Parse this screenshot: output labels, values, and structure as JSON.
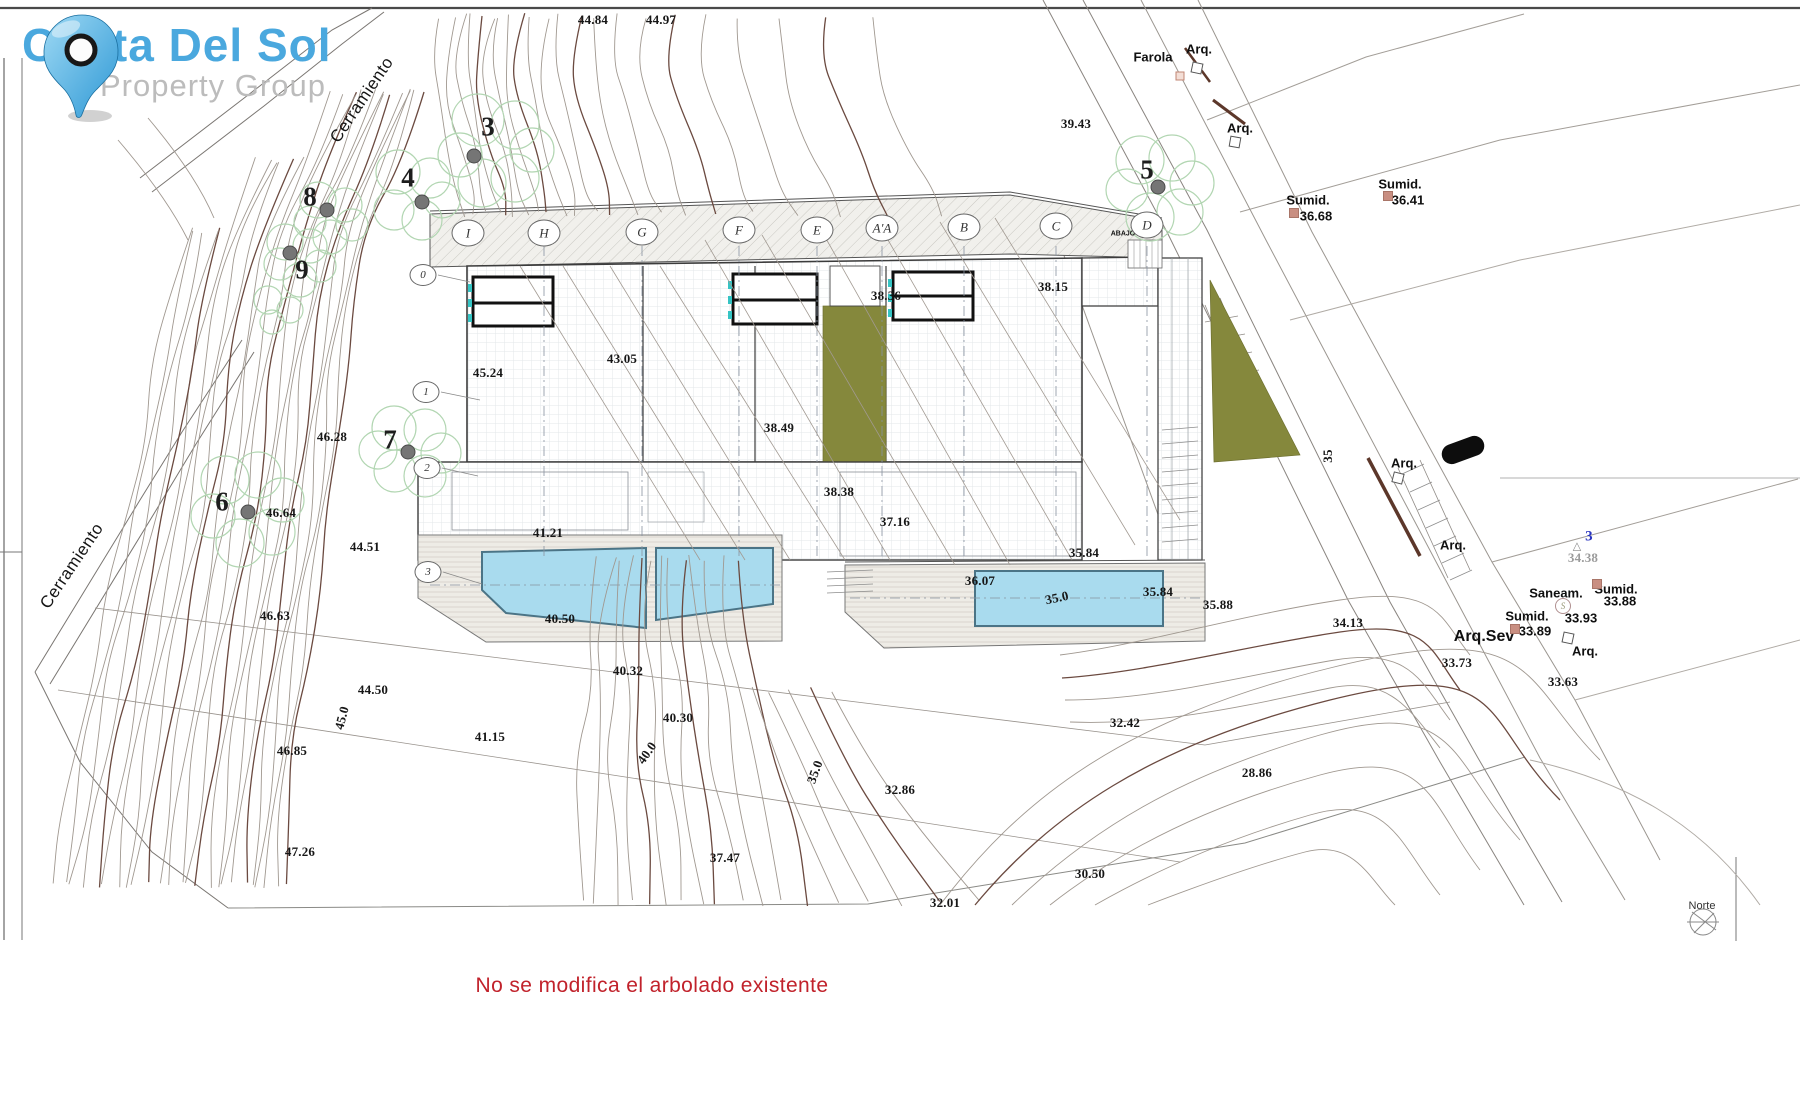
{
  "logo": {
    "title": "Costa Del Sol",
    "subtitle": "Property Group",
    "title_color": "#4aa8de",
    "subtitle_color": "#bcbcbc"
  },
  "note": {
    "text": "No se modifica el arbolado existente",
    "color": "#c1222b"
  },
  "compass": {
    "label": "Norte"
  },
  "colors": {
    "contour": "#a09890",
    "contour_index": "#6b4a40",
    "pool": "#a9dbee",
    "olive": "#85883c",
    "tree_canopy": "#b2d6b2",
    "marker_salmon": "#c98f82",
    "note_red": "#c1222b",
    "logo_blue": "#4aa8de"
  },
  "boundary_labels": [
    {
      "t": "Cerramiento",
      "x": 362,
      "y": 100,
      "r": -56
    },
    {
      "t": "Cerramiento",
      "x": 72,
      "y": 566,
      "r": -56
    }
  ],
  "grid_bubbles": [
    {
      "t": "I",
      "x": 468,
      "y": 233
    },
    {
      "t": "H",
      "x": 544,
      "y": 233
    },
    {
      "t": "G",
      "x": 642,
      "y": 232
    },
    {
      "t": "F",
      "x": 739,
      "y": 230
    },
    {
      "t": "E",
      "x": 817,
      "y": 230
    },
    {
      "t": "A'A",
      "x": 882,
      "y": 228
    },
    {
      "t": "B",
      "x": 964,
      "y": 227
    },
    {
      "t": "C",
      "x": 1056,
      "y": 226
    },
    {
      "t": "D",
      "x": 1147,
      "y": 225
    }
  ],
  "level_bubbles": [
    {
      "t": "0",
      "x": 423,
      "y": 275
    },
    {
      "t": "1",
      "x": 426,
      "y": 392
    },
    {
      "t": "2",
      "x": 427,
      "y": 468
    },
    {
      "t": "3",
      "x": 428,
      "y": 572
    }
  ],
  "tree_numbers": [
    {
      "t": "3",
      "x": 488,
      "y": 127
    },
    {
      "t": "4",
      "x": 408,
      "y": 178
    },
    {
      "t": "8",
      "x": 310,
      "y": 197
    },
    {
      "t": "9",
      "x": 302,
      "y": 270
    },
    {
      "t": "7",
      "x": 390,
      "y": 440
    },
    {
      "t": "6",
      "x": 222,
      "y": 502
    },
    {
      "t": "5",
      "x": 1147,
      "y": 170
    }
  ],
  "elevation_labels": [
    {
      "t": "44.84",
      "x": 593,
      "y": 20
    },
    {
      "t": "44.97",
      "x": 661,
      "y": 20
    },
    {
      "t": "39.43",
      "x": 1076,
      "y": 124
    },
    {
      "t": "38.36",
      "x": 886,
      "y": 296
    },
    {
      "t": "38.15",
      "x": 1053,
      "y": 287
    },
    {
      "t": "43.05",
      "x": 622,
      "y": 359
    },
    {
      "t": "45.24",
      "x": 488,
      "y": 373
    },
    {
      "t": "38.49",
      "x": 779,
      "y": 428
    },
    {
      "t": "46.28",
      "x": 332,
      "y": 437
    },
    {
      "t": "38.38",
      "x": 839,
      "y": 492
    },
    {
      "t": "46.64",
      "x": 281,
      "y": 513
    },
    {
      "t": "37.16",
      "x": 895,
      "y": 522
    },
    {
      "t": "41.21",
      "x": 548,
      "y": 533
    },
    {
      "t": "44.51",
      "x": 365,
      "y": 547
    },
    {
      "t": "35.84",
      "x": 1084,
      "y": 553
    },
    {
      "t": "36.07",
      "x": 980,
      "y": 581
    },
    {
      "t": "35.0",
      "x": 1057,
      "y": 598,
      "r": -12
    },
    {
      "t": "35.84",
      "x": 1158,
      "y": 592
    },
    {
      "t": "35.88",
      "x": 1218,
      "y": 605
    },
    {
      "t": "34.13",
      "x": 1348,
      "y": 623
    },
    {
      "t": "46.63",
      "x": 275,
      "y": 616
    },
    {
      "t": "40.50",
      "x": 560,
      "y": 619
    },
    {
      "t": "40.32",
      "x": 628,
      "y": 671
    },
    {
      "t": "33.73",
      "x": 1457,
      "y": 663
    },
    {
      "t": "33.63",
      "x": 1563,
      "y": 682
    },
    {
      "t": "44.50",
      "x": 373,
      "y": 690
    },
    {
      "t": "45.0",
      "x": 342,
      "y": 718,
      "r": -75
    },
    {
      "t": "32.42",
      "x": 1125,
      "y": 723
    },
    {
      "t": "41.15",
      "x": 490,
      "y": 737
    },
    {
      "t": "46.85",
      "x": 292,
      "y": 751
    },
    {
      "t": "40.30",
      "x": 678,
      "y": 718
    },
    {
      "t": "40.0",
      "x": 647,
      "y": 753,
      "r": -55
    },
    {
      "t": "35.0",
      "x": 815,
      "y": 772,
      "r": -70
    },
    {
      "t": "28.86",
      "x": 1257,
      "y": 773
    },
    {
      "t": "32.86",
      "x": 900,
      "y": 790
    },
    {
      "t": "37.47",
      "x": 725,
      "y": 858
    },
    {
      "t": "30.50",
      "x": 1090,
      "y": 874
    },
    {
      "t": "32.01",
      "x": 945,
      "y": 903
    },
    {
      "t": "47.26",
      "x": 300,
      "y": 852
    },
    {
      "t": "34.38",
      "x": 1583,
      "y": 558,
      "c": "#9b9b9b"
    },
    {
      "t": "35",
      "x": 1328,
      "y": 456,
      "r": -90
    },
    {
      "t": "3",
      "x": 1589,
      "y": 537,
      "c": "#2a35c0",
      "s": 15
    }
  ],
  "annotation_labels": [
    {
      "t": "Farola",
      "x": 1153,
      "y": 57
    },
    {
      "t": "Arq.",
      "x": 1199,
      "y": 49
    },
    {
      "t": "Arq.",
      "x": 1240,
      "y": 128
    },
    {
      "t": "Sumid.",
      "x": 1308,
      "y": 200
    },
    {
      "t": "36.68",
      "x": 1316,
      "y": 216
    },
    {
      "t": "Sumid.",
      "x": 1400,
      "y": 184
    },
    {
      "t": "36.41",
      "x": 1408,
      "y": 200
    },
    {
      "t": "Arq.",
      "x": 1404,
      "y": 463
    },
    {
      "t": "Arq.",
      "x": 1453,
      "y": 545
    },
    {
      "t": "Arq.Sev",
      "x": 1484,
      "y": 637,
      "s": 16
    },
    {
      "t": "Saneam.",
      "x": 1556,
      "y": 593
    },
    {
      "t": "Sumid.",
      "x": 1527,
      "y": 616
    },
    {
      "t": "33.89",
      "x": 1535,
      "y": 631
    },
    {
      "t": "33.93",
      "x": 1581,
      "y": 618
    },
    {
      "t": "Sumid.",
      "x": 1616,
      "y": 589
    },
    {
      "t": "33.88",
      "x": 1620,
      "y": 601
    },
    {
      "t": "Arq.",
      "x": 1585,
      "y": 651
    },
    {
      "t": "ABAJO",
      "x": 1123,
      "y": 234,
      "s": 7
    }
  ],
  "markers": [
    {
      "type": "square",
      "x": 1197,
      "y": 68,
      "r": 12
    },
    {
      "type": "square",
      "x": 1235,
      "y": 142,
      "r": 10
    },
    {
      "type": "square",
      "x": 1398,
      "y": 478,
      "r": 14
    },
    {
      "type": "square",
      "x": 1568,
      "y": 638,
      "r": 12
    },
    {
      "type": "salmon",
      "x": 1294,
      "y": 213
    },
    {
      "type": "salmon",
      "x": 1388,
      "y": 196
    },
    {
      "type": "salmon",
      "x": 1515,
      "y": 629
    },
    {
      "type": "salmon",
      "x": 1597,
      "y": 584
    },
    {
      "type": "diamond",
      "x": 1180,
      "y": 76
    },
    {
      "type": "circleS",
      "x": 1563,
      "y": 606,
      "t": "S"
    },
    {
      "type": "tri",
      "x": 1577,
      "y": 546,
      "t": "△"
    },
    {
      "type": "car",
      "x": 1463,
      "y": 450,
      "r": -20
    },
    {
      "type": "dot",
      "x": 474,
      "y": 156
    },
    {
      "type": "dot",
      "x": 422,
      "y": 202
    },
    {
      "type": "dot",
      "x": 327,
      "y": 210
    },
    {
      "type": "dot",
      "x": 290,
      "y": 253
    },
    {
      "type": "dot",
      "x": 408,
      "y": 452
    },
    {
      "type": "dot",
      "x": 248,
      "y": 512
    },
    {
      "type": "dot",
      "x": 1158,
      "y": 187
    }
  ]
}
